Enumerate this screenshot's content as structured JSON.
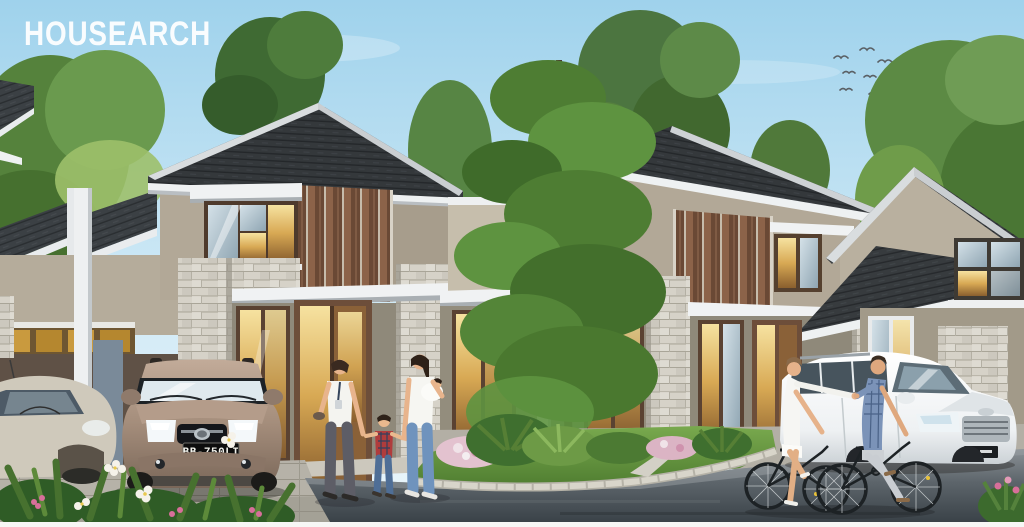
{
  "brand": {
    "watermark": "HOUSEARCH"
  },
  "vehicles": {
    "brown_suv": {
      "type": "bronze Toyota SUV, front view",
      "plate": "BB-750LI"
    },
    "white_suv": {
      "type": "white SUV, three-quarter front view",
      "plate_visible": false
    },
    "silver_car": {
      "type": "silver hatchback in carport, partially cropped"
    }
  },
  "scene": {
    "setting": "architectural rendering of modern two-story row houses with stone pillars, brown wood slat panels and dark shingle roofs",
    "people": [
      "woman in white tee with lanyard",
      "child in red plaid shirt",
      "woman carrying baby",
      "female cyclist in white",
      "male cyclist in plaid shirt"
    ],
    "landscape": [
      "tall center tree",
      "lawn island with ferns and flower bushes",
      "plumeria flowers foreground",
      "flock of birds top right"
    ]
  },
  "palette": {
    "sky_top": "#a2d5ee",
    "sky_horizon": "#eaf5fb",
    "roof": "#34383b",
    "trim_white": "#f1f3f4",
    "wall_beige": "#b6ad9c",
    "wood_brown": "#7c5840",
    "stone": "#d6d2c8",
    "window_warm": "#e4c172",
    "lawn": "#6a9a40",
    "road": "#4a5258",
    "suv_bronze": "#a08a79",
    "suv_white": "#f3f5f6"
  }
}
